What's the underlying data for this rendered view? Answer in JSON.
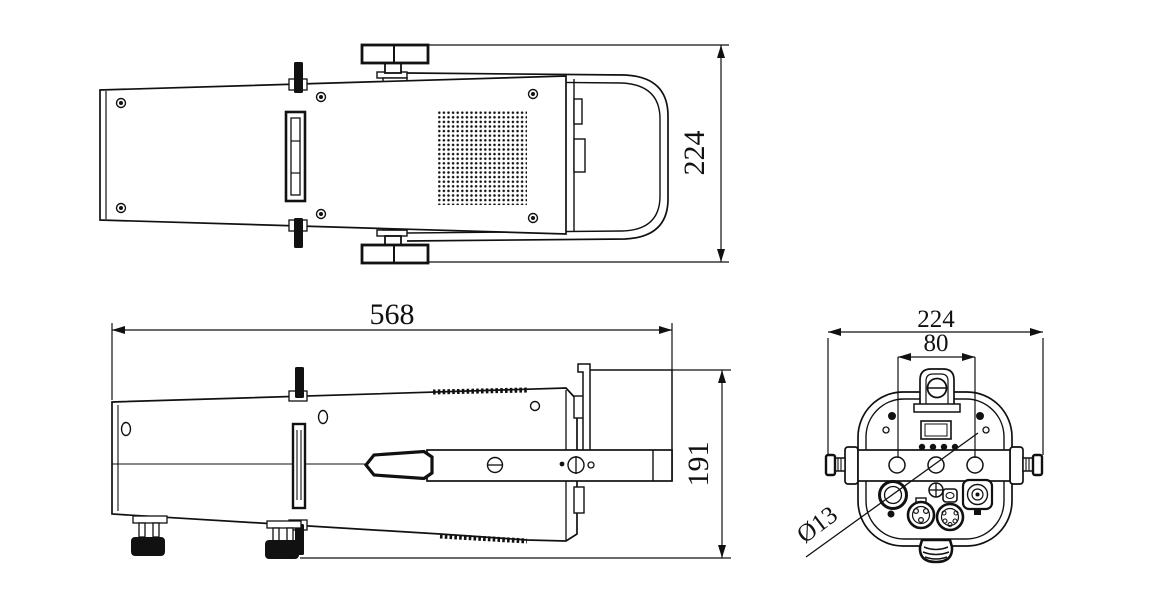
{
  "drawing": {
    "top_view": {
      "height_dim": "224"
    },
    "side_view": {
      "length_dim": "568",
      "height_dim": "191"
    },
    "rear_view": {
      "width_dim": "224",
      "bracket_dim": "80",
      "hole_dim": "Ø13"
    }
  }
}
